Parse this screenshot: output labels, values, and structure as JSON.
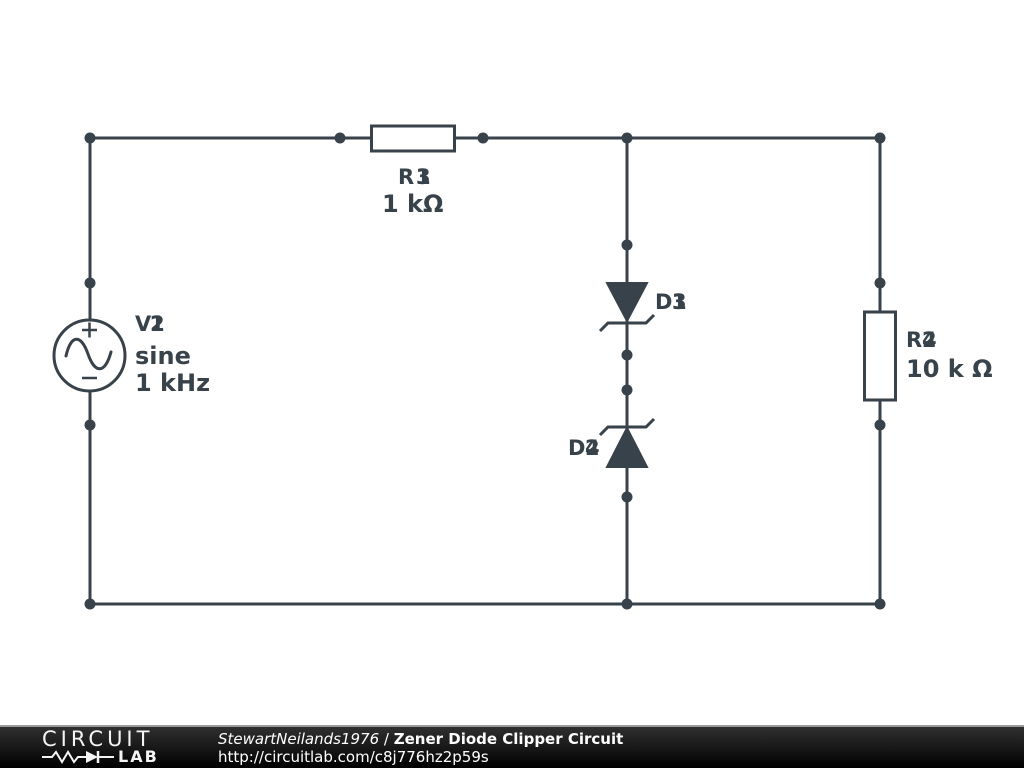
{
  "canvas": {
    "background": "#ffffff",
    "stroke_color": "#38424a"
  },
  "components": {
    "source": {
      "ref_prefix": "V",
      "ref_digit_front": "2",
      "ref_digit_back": "1",
      "waveform": "sine",
      "frequency": "1 kHz"
    },
    "resistor_top": {
      "ref_prefix": "R",
      "ref_digit_front": "3",
      "ref_digit_back": "1",
      "value": "1 kΩ"
    },
    "zener_top": {
      "ref_prefix": "D",
      "ref_digit_front": "3",
      "ref_digit_back": "1"
    },
    "zener_bottom": {
      "ref_prefix": "D",
      "ref_digit_front": "2",
      "ref_digit_back": "4"
    },
    "resistor_right": {
      "ref_prefix": "R",
      "ref_digit_front": "2",
      "ref_digit_back": "4",
      "value": "10 k Ω"
    }
  },
  "footer": {
    "logo_top": "CIRCUIT",
    "logo_bottom": "LAB",
    "author": "StewartNeilands1976",
    "separator": " / ",
    "title": "Zener Diode Clipper Circuit",
    "url": "http://circuitlab.com/c8j776hz2p59s"
  }
}
